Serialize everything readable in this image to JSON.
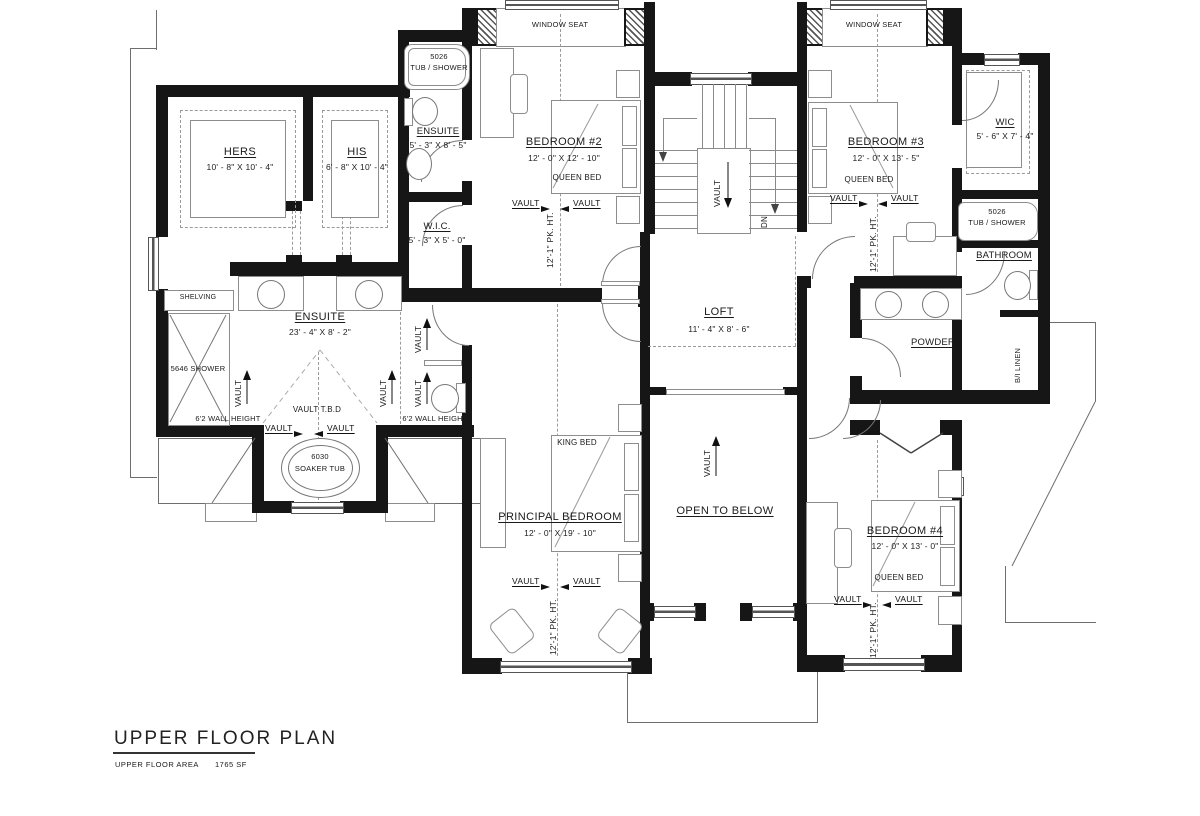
{
  "title_block": {
    "title": "UPPER FLOOR PLAN",
    "area_label": "UPPER FLOOR AREA",
    "area_value": "1765 SF"
  },
  "rooms": {
    "hers": {
      "name": "HERS",
      "dims": "10' - 8\" X 10' - 4\""
    },
    "his": {
      "name": "HIS",
      "dims": "6' - 8\" X 10' - 4\""
    },
    "ensuite2": {
      "name": "ENSUITE",
      "dims": "5' - 3\" X 8' - 5\""
    },
    "wic2": {
      "name": "W.I.C.",
      "dims": "5' - 3\" X 5' - 0\""
    },
    "bedroom2": {
      "name": "BEDROOM #2",
      "dims": "12' - 0\" X 12' - 10\"",
      "bed": "QUEEN BED"
    },
    "bedroom3": {
      "name": "BEDROOM #3",
      "dims": "12' - 0\" X 13' - 5\"",
      "bed": "QUEEN BED"
    },
    "wic3": {
      "name": "WIC",
      "dims": "5' - 6\" X 7' - 4\""
    },
    "bathroom": {
      "name": "BATHROOM"
    },
    "powder": {
      "name": "POWDER"
    },
    "loft": {
      "name": "LOFT",
      "dims": "11' - 4\" X 8' - 6\""
    },
    "principal": {
      "name": "PRINCIPAL BEDROOM",
      "dims": "12' - 0\" X 19' - 10\"",
      "bed": "KING BED"
    },
    "open_below": {
      "name": "OPEN TO BELOW"
    },
    "bedroom4": {
      "name": "BEDROOM #4",
      "dims": "12' - 0\" X 13' - 0\"",
      "bed": "QUEEN BED"
    },
    "ensuite_master": {
      "name": "ENSUITE",
      "dims": "23' - 4\" X 8' - 2\""
    }
  },
  "fixtures": {
    "tub_model": "5026",
    "tub_label": "TUB / SHOWER",
    "shower": "5646 SHOWER",
    "soaker_model": "6030",
    "soaker_label": "SOAKER TUB",
    "shelving": "SHELVING",
    "linen": "B/I LINEN"
  },
  "annotations": {
    "window_seat": "WINDOW SEAT",
    "vault": "VAULT",
    "vault_tbd": "VAULT T.B.D",
    "wall_height": "6'2 WALL HEIGHT",
    "pk_ht": "12'-1\" PK. HT.",
    "dn": "DN"
  },
  "colors": {
    "wall": "#161616",
    "thin_line": "#6e6e6e",
    "text": "#1a1a1a"
  }
}
